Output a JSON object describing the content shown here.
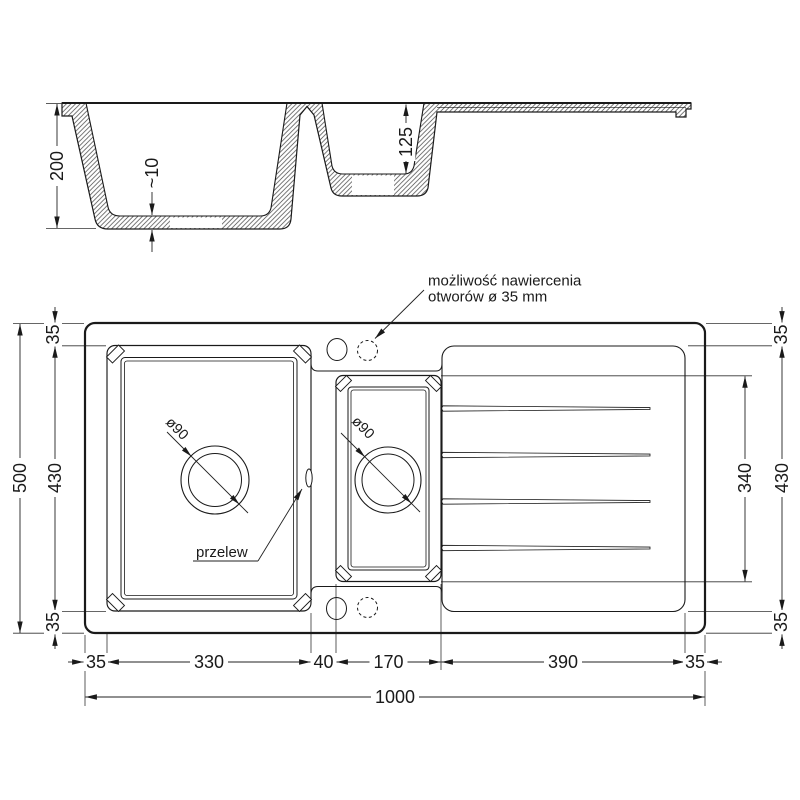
{
  "colors": {
    "line": "#1a1a1a",
    "background": "#ffffff"
  },
  "section": {
    "depth_total": "200",
    "floor_thickness": "~10",
    "small_bowl_depth": "125"
  },
  "plan": {
    "overall_height": "500",
    "overall_width": "1000",
    "left_top": "35",
    "left_middle": "430",
    "left_bottom": "35",
    "right_top": "35",
    "right_middle": "430",
    "right_bottom": "35",
    "drainer_span": "340",
    "bottom_dims": [
      "35",
      "330",
      "40",
      "170",
      "390",
      "35"
    ],
    "drain_main": "ø90",
    "drain_small": "ø90",
    "overflow_label": "przelew",
    "note_line1": "możliwość nawiercenia",
    "note_line2": "otworów ø 35 mm"
  }
}
